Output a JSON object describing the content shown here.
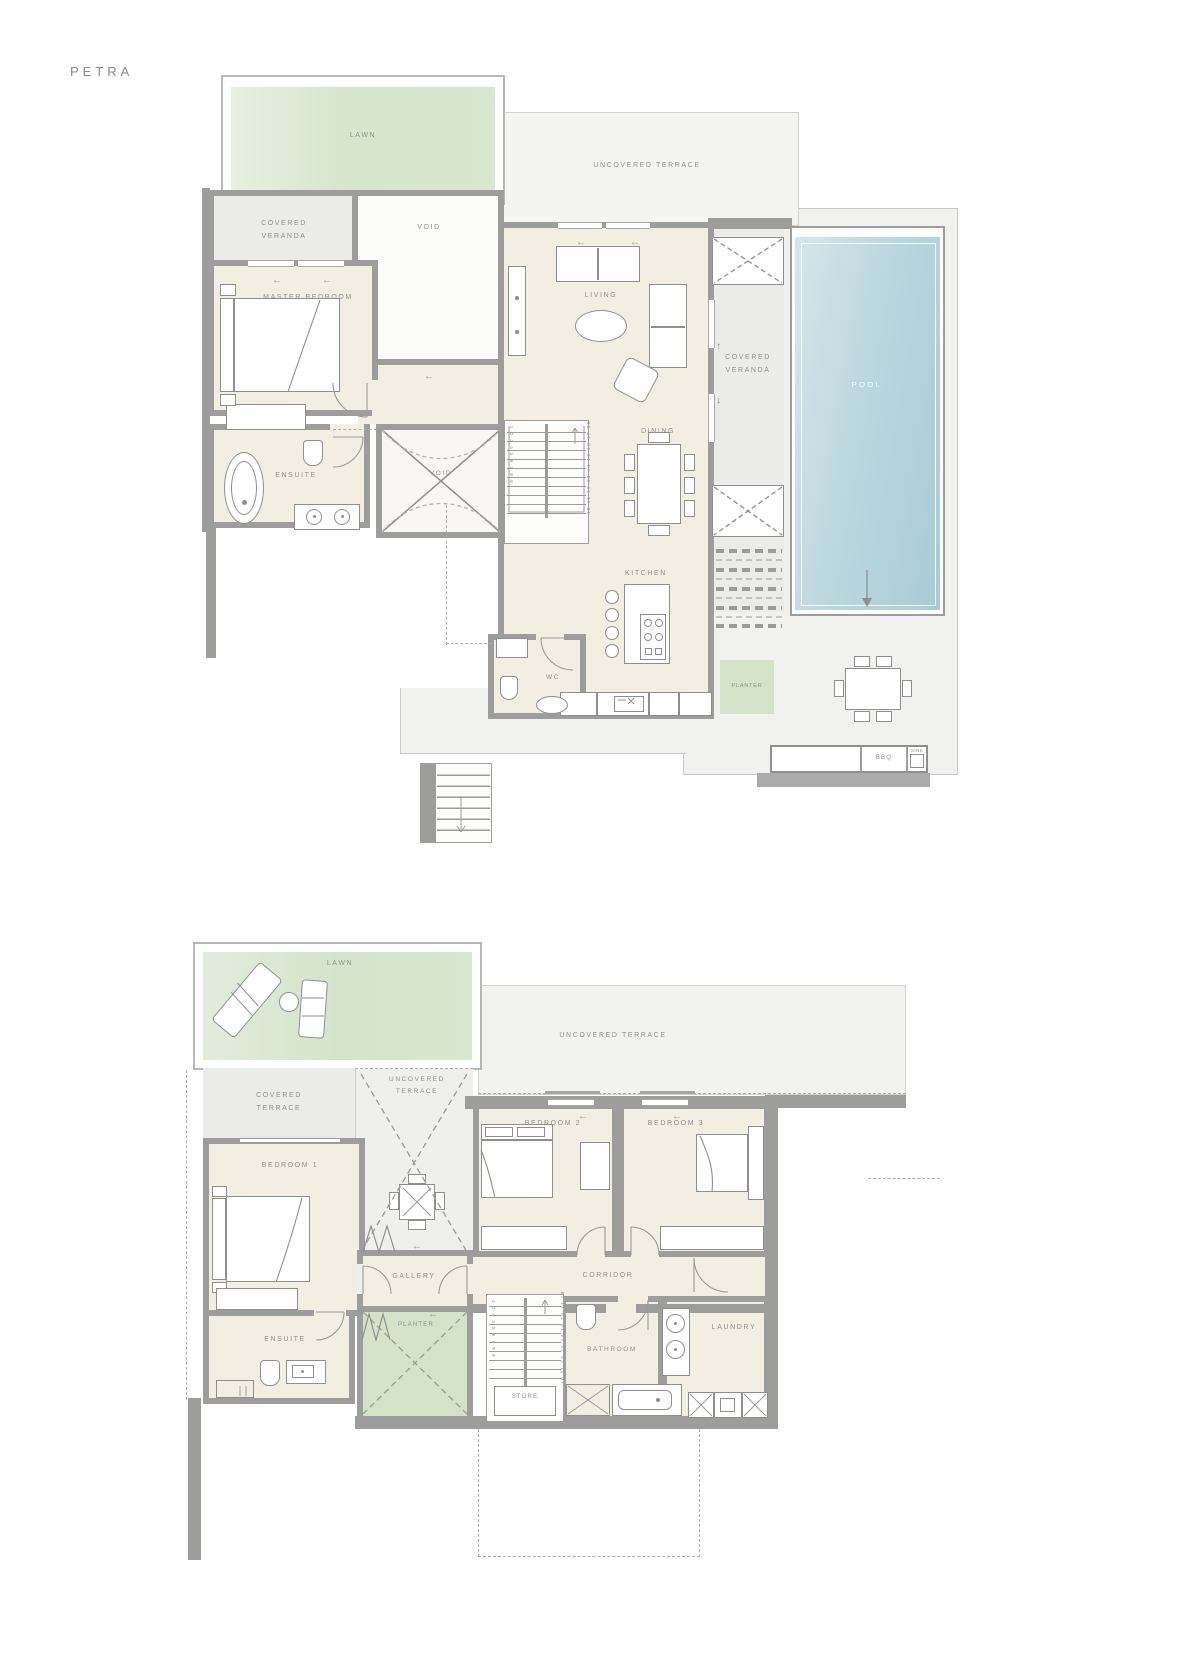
{
  "title": "PETRA",
  "palette": {
    "wall": "#9d9d9b",
    "room_cream": "#f2eee2",
    "terrace_gray": "#f1f1ef",
    "lawn_green": "#d9e7d1",
    "planter_green": "#d4e2c7",
    "pool_blue": "#b9d5dd",
    "label_gray": "#8f908e"
  },
  "icons": {
    "arrow_left": "←",
    "arrow_up": "↑",
    "arrow_down": "↓"
  },
  "upper": {
    "lawn": "LAWN",
    "terrace": "UNCOVERED TERRACE",
    "veranda_left": "COVERED VERANDA",
    "void_top": "VOID",
    "master": "MASTER BEDROOM",
    "living": "LIVING",
    "ensuite": "ENSUITE",
    "void_mid": "VOID",
    "dining": "DINING",
    "kitchen": "KITCHEN",
    "wc": "WC",
    "veranda_right": "COVERED VERANDA",
    "pool": "POOL",
    "planter": "PLANTER",
    "bbq": "BBQ",
    "sink": "SINK",
    "stairs_left": "1 2 3 4 5 6 7 8 9",
    "stairs_right": "10 11 12 13 14 15 16 17 18"
  },
  "lower": {
    "lawn": "LAWN",
    "terrace_main": "UNCOVERED TERRACE",
    "terrace_covered": "COVERED TERRACE",
    "terrace_small": "UNCOVERED TERRACE",
    "bedroom1": "BEDROOM 1",
    "bedroom2": "BEDROOM 2",
    "bedroom3": "BEDROOM 3",
    "gallery": "GALLERY",
    "corridor": "CORRIDOR",
    "ensuite": "ENSUITE",
    "planter": "PLANTER",
    "store": "STORE",
    "bathroom": "BATHROOM",
    "laundry": "LAUNDRY",
    "stairs_left": "1 2 3 4 5 6 7 8 9",
    "stairs_right": "10 11 12 13 14 15 16 17 18"
  }
}
